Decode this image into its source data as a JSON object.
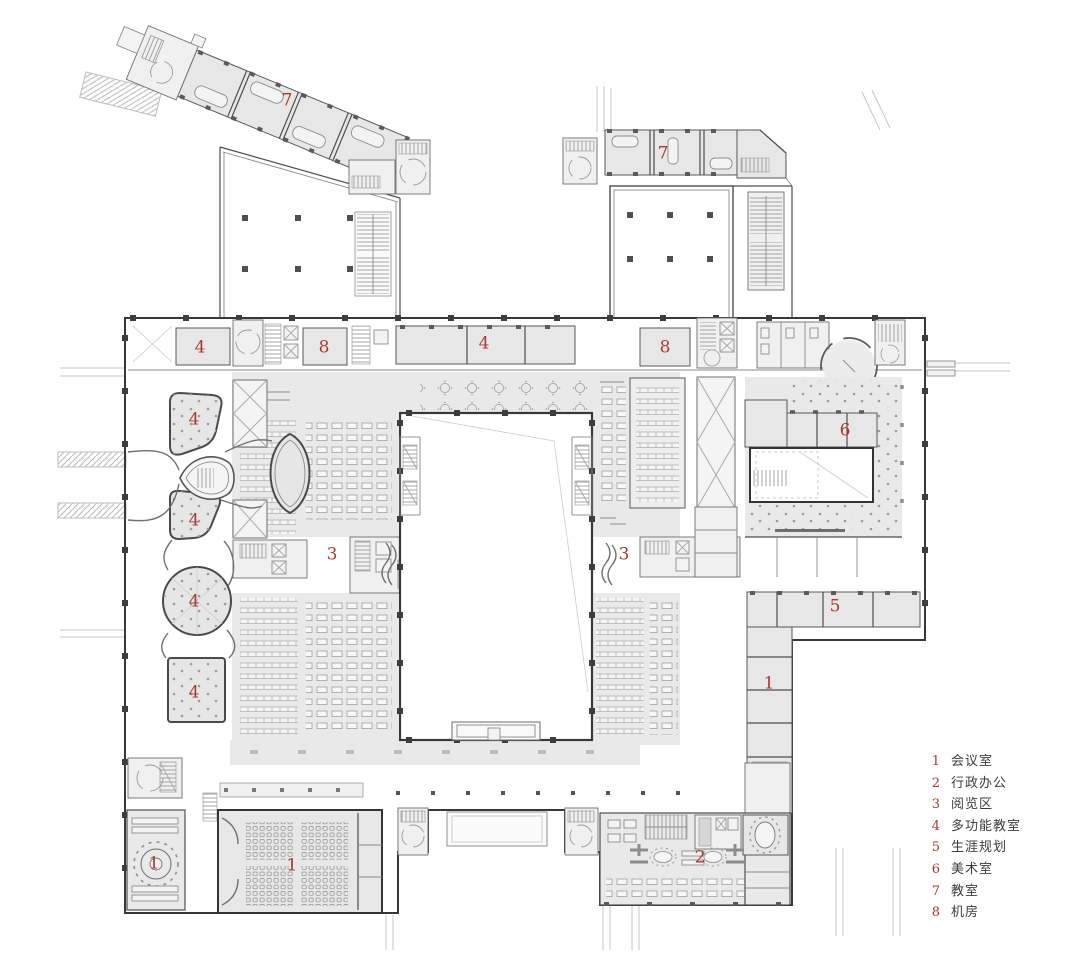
{
  "plan": {
    "type": "architectural-floor-plan",
    "colors": {
      "accent_red": "#a93a30",
      "room_fill": "#e7e7e7",
      "wall": "#383838",
      "legend_text": "#3c3c3c"
    },
    "room_markers": [
      {
        "number": "7",
        "x": 287,
        "y": 101
      },
      {
        "number": "7",
        "x": 663,
        "y": 154
      },
      {
        "number": "4",
        "x": 200,
        "y": 348
      },
      {
        "number": "8",
        "x": 324,
        "y": 348
      },
      {
        "number": "4",
        "x": 484,
        "y": 344
      },
      {
        "number": "8",
        "x": 665,
        "y": 348
      },
      {
        "number": "4",
        "x": 194,
        "y": 420
      },
      {
        "number": "6",
        "x": 845,
        "y": 431
      },
      {
        "number": "4",
        "x": 194,
        "y": 521
      },
      {
        "number": "3",
        "x": 332,
        "y": 555
      },
      {
        "number": "3",
        "x": 624,
        "y": 555
      },
      {
        "number": "4",
        "x": 194,
        "y": 602
      },
      {
        "number": "5",
        "x": 835,
        "y": 607
      },
      {
        "number": "4",
        "x": 194,
        "y": 693
      },
      {
        "number": "1",
        "x": 769,
        "y": 684
      },
      {
        "number": "1",
        "x": 154,
        "y": 864
      },
      {
        "number": "1",
        "x": 292,
        "y": 866
      },
      {
        "number": "2",
        "x": 700,
        "y": 858
      }
    ]
  },
  "legend": {
    "x": 926,
    "y": 750,
    "items": [
      {
        "number": "1",
        "label": "会议室"
      },
      {
        "number": "2",
        "label": "行政办公"
      },
      {
        "number": "3",
        "label": "阅览区"
      },
      {
        "number": "4",
        "label": "多功能教室"
      },
      {
        "number": "5",
        "label": "生涯规划"
      },
      {
        "number": "6",
        "label": "美术室"
      },
      {
        "number": "7",
        "label": "教室"
      },
      {
        "number": "8",
        "label": "机房"
      }
    ]
  }
}
